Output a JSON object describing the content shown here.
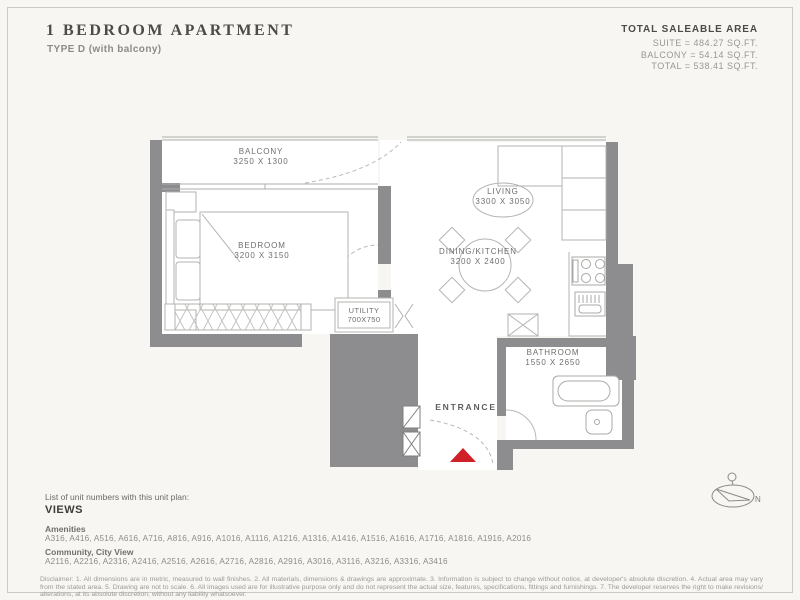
{
  "header": {
    "title": "1 BEDROOM APARTMENT",
    "subtitle": "TYPE D (with balcony)"
  },
  "area_summary": {
    "heading": "TOTAL SALEABLE AREA",
    "lines": [
      "SUITE = 484.27 SQ.FT.",
      "BALCONY = 54.14 SQ.FT.",
      "TOTAL = 538.41 SQ.FT."
    ]
  },
  "floor_plan": {
    "rooms": {
      "balcony": {
        "name": "BALCONY",
        "dimensions": "3250 X 1300"
      },
      "bedroom": {
        "name": "BEDROOM",
        "dimensions": "3200 X 3150"
      },
      "living": {
        "name": "LIVING",
        "dimensions": "3300 X 3050"
      },
      "dining_kitchen": {
        "name": "DINING/KITCHEN",
        "dimensions": "3200 X 2400"
      },
      "utility": {
        "name": "UTILITY",
        "dimensions": "700X750"
      },
      "bathroom": {
        "name": "BATHROOM",
        "dimensions": "1550 X 2650"
      },
      "entrance": {
        "name": "ENTRANCE"
      }
    },
    "compass": {
      "label": "N"
    }
  },
  "unit_list": {
    "intro": "List of unit numbers with this unit plan:",
    "heading": "VIEWS",
    "groups": [
      {
        "label": "Amenities",
        "units": "A316, A416, A516, A616, A716, A816, A916, A1016, A1116, A1216, A1316, A1416, A1516, A1616, A1716, A1816, A1916, A2016"
      },
      {
        "label": "Community, City View",
        "units": "A2116, A2216, A2316, A2416, A2516, A2616, A2716, A2816, A2916, A3016, A3116, A3216, A3316, A3416"
      }
    ]
  },
  "disclaimer": "Disclaimer: 1. All dimensions are in metric, measured to wall finishes. 2. All materials, dimensions & drawings are approximate. 3. Information is subject to change without notice, at developer's absolute discretion. 4. Actual area may vary from the stated area. 5. Drawing are not to scale. 6. All images used are for illustrative purpose only and do not represent the actual size, features, specifications, fittings and furnishings. 7. The developer reserves the right to make revisions/ alterations, at its absolute discretion, without any liability whatsoever.",
  "colors": {
    "wall": "#8d8d8f",
    "line": "#b3b3b1",
    "accent_red": "#cf2127",
    "background": "#f7f6f2"
  }
}
